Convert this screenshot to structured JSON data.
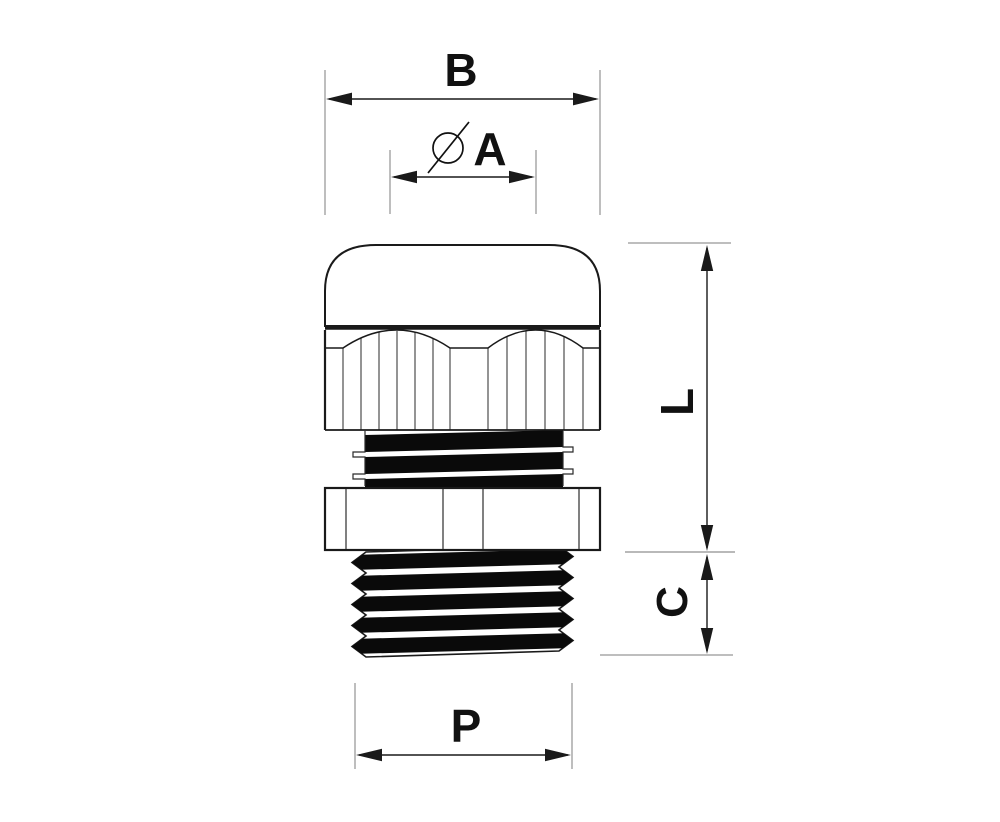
{
  "drawing": {
    "kind": "dimensioned technical drawing",
    "labels": {
      "b": "B",
      "a": "A",
      "l": "L",
      "c": "C",
      "p": "P"
    },
    "symbols": {
      "diameter": "⌀"
    },
    "colors": {
      "background": "#ffffff",
      "outline": "#1a1a1a",
      "dimension_line": "#1a1a1a",
      "extension_line": "#a8a8a8",
      "thread_fill": "#0a0a0a",
      "label_text": "#111111"
    }
  }
}
